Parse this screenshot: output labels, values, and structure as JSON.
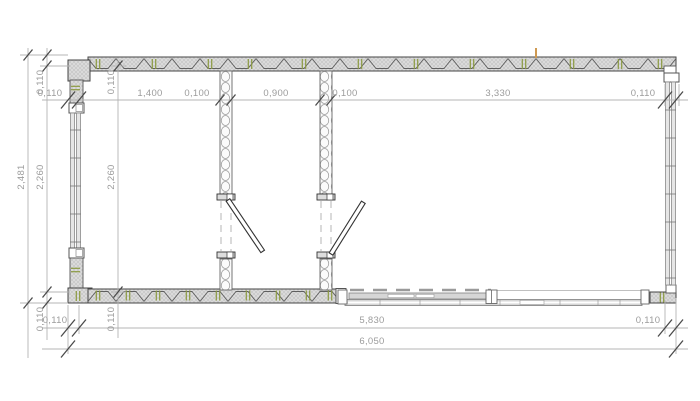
{
  "plan": {
    "kind": "architectural-floor-plan",
    "dims": {
      "top": [
        "0,110",
        "1,400",
        "0,100",
        "0,900",
        "0,100",
        "3,330",
        "0,110"
      ],
      "bottom_inner": [
        "0,110",
        "5,830",
        "0,110"
      ],
      "total_width": "6,050",
      "total_height": "2,481",
      "left_outer": [
        "0,110",
        "2,260",
        "0,110"
      ],
      "left_inner": [
        "0,110",
        "2,260",
        "0,110"
      ]
    },
    "colors": {
      "line": "#444444",
      "dimension_line": "#b4b4b4",
      "dimension_text": "#9c9c9c",
      "wall_fill": "#dcdcdc",
      "fastener_green": "#8b9a40",
      "marker_orange": "#cf9a52"
    }
  }
}
